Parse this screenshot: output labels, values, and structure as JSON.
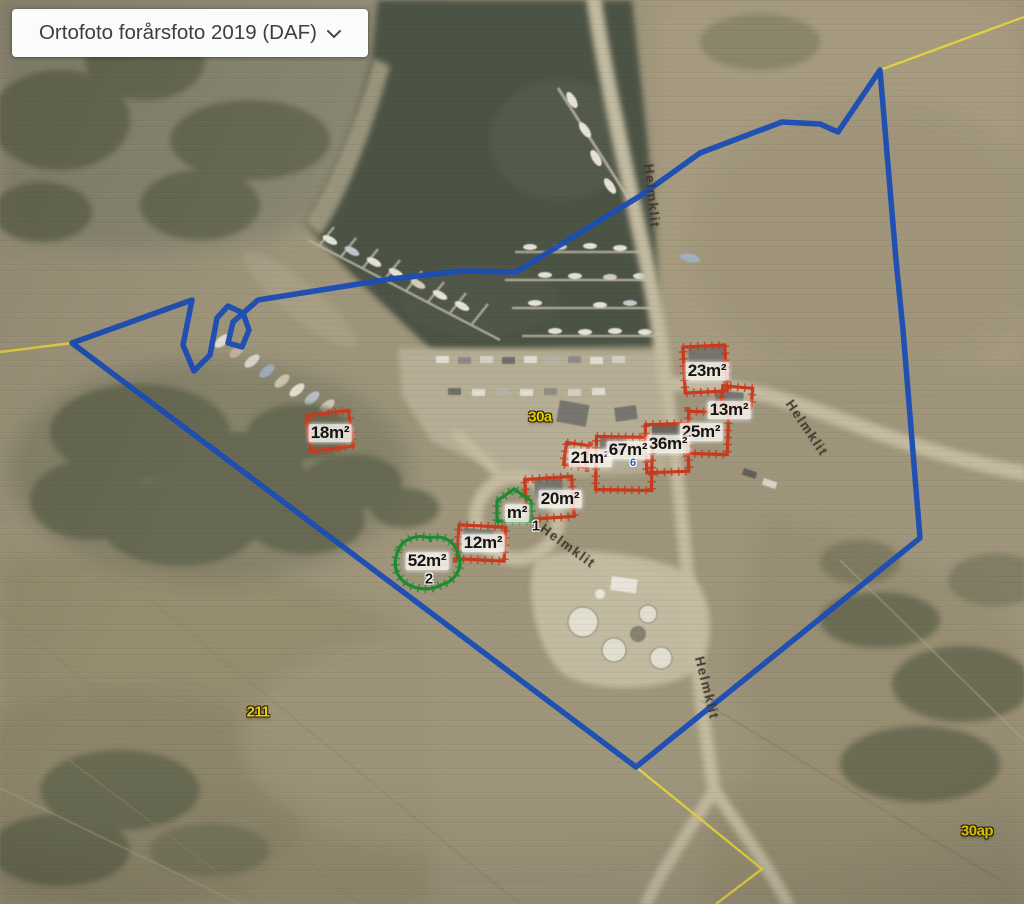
{
  "ui": {
    "basemap_dropdown": {
      "label": "Ortofoto forårsfoto 2019 (DAF)",
      "chevron_icon": "chevron-down"
    }
  },
  "map": {
    "boundary_color": "#1b4db5",
    "cadastral_line_color": "#e6d23f",
    "building_marker_colors": {
      "red": "#c93a1d",
      "green": "#1d8b2f"
    },
    "area_labels": [
      {
        "text": "18m²",
        "marker": "red",
        "x": 330,
        "y": 433
      },
      {
        "text": "23m²",
        "marker": "red",
        "x": 707,
        "y": 371
      },
      {
        "text": "13m²",
        "marker": "red",
        "x": 729,
        "y": 410
      },
      {
        "text": "25m²",
        "marker": "red",
        "x": 701,
        "y": 432
      },
      {
        "text": "36m²",
        "marker": "red",
        "x": 668,
        "y": 444
      },
      {
        "text": "21m²",
        "marker": "red",
        "x": 590,
        "y": 458
      },
      {
        "text": "67m²",
        "marker": "red",
        "x": 628,
        "y": 450
      },
      {
        "text": "20m²",
        "marker": "red",
        "x": 560,
        "y": 499
      },
      {
        "text": "12m²",
        "marker": "red",
        "x": 483,
        "y": 543
      },
      {
        "text": "52m²",
        "marker": "green",
        "x": 427,
        "y": 561
      },
      {
        "text": "m²",
        "marker": "green",
        "x": 517,
        "y": 513
      }
    ],
    "marker_numbers": [
      {
        "text": "1",
        "x": 536,
        "y": 526,
        "color": "#161616",
        "size": 15
      },
      {
        "text": "2",
        "x": 429,
        "y": 579,
        "color": "#161616",
        "size": 15
      },
      {
        "text": "6",
        "x": 633,
        "y": 463,
        "color": "#2d55c9",
        "size": 11
      }
    ],
    "parcel_labels": [
      {
        "text": "30a",
        "x": 540,
        "y": 417
      },
      {
        "text": "211",
        "x": 258,
        "y": 712
      },
      {
        "text": "30ap",
        "x": 977,
        "y": 831
      }
    ],
    "road_labels": [
      {
        "text": "Helmklit",
        "x": 652,
        "y": 196,
        "angle": 84
      },
      {
        "text": "Helmklit",
        "x": 807,
        "y": 428,
        "angle": 56
      },
      {
        "text": "Helmklit",
        "x": 568,
        "y": 546,
        "angle": 36
      },
      {
        "text": "Helmklit",
        "x": 707,
        "y": 688,
        "angle": 76
      }
    ]
  }
}
